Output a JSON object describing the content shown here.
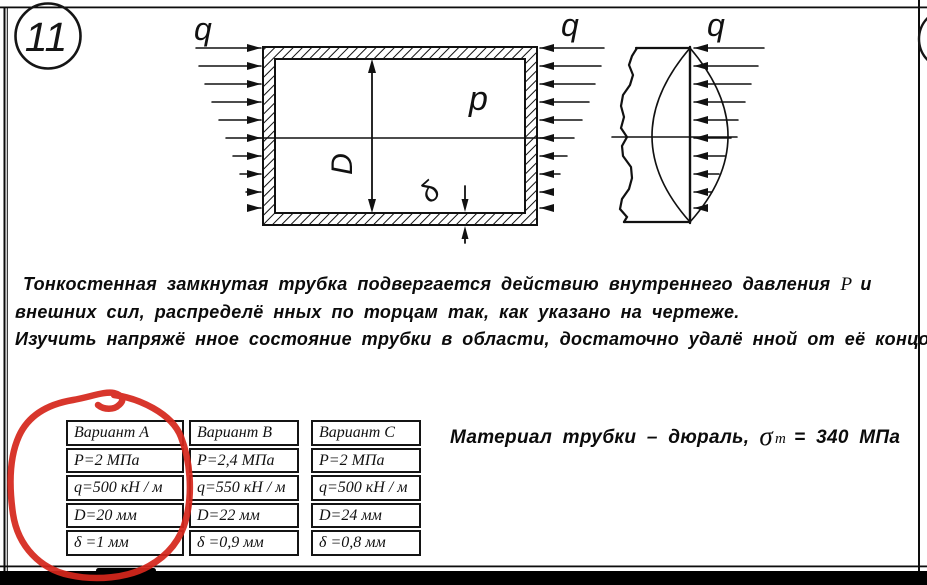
{
  "page": {
    "problem_number": "11"
  },
  "figure": {
    "q_label_left": "q",
    "q_label_mid": "q",
    "q_label_right": "q",
    "pressure_label": "p",
    "diameter_label": "D",
    "thickness_label": "δ"
  },
  "problem": {
    "line1_pre": "Тонкостенная замкнутая трубка подвергается действию внутреннего давления",
    "line1_symbol": "P",
    "line1_post": "и",
    "line2": "внешних сил, распределё нных по торцам так, как указано на чертеже.",
    "line3": "Изучить напряжё нное состояние трубки в области, достаточно удалё нной от её концов."
  },
  "material": {
    "text": "Материал трубки – дюраль,",
    "sigma": "σ",
    "sigma_sub": "m",
    "value": "= 340 МПа"
  },
  "table": {
    "columns": [
      {
        "header": "Вариант А",
        "rows": [
          "P=2 МПа",
          "q=500 кН / м",
          "D=20 мм",
          "δ =1 мм"
        ]
      },
      {
        "header": "Вариант В",
        "rows": [
          "P=2,4 МПа",
          "q=550 кН / м",
          "D=22 мм",
          "δ =0,9 мм"
        ]
      },
      {
        "header": "Вариант С",
        "rows": [
          "P=2 МПа",
          "q=500 кН / м",
          "D=24 мм",
          "δ =0,8 мм"
        ]
      }
    ]
  },
  "annotation": {
    "color": "#d5271c"
  }
}
